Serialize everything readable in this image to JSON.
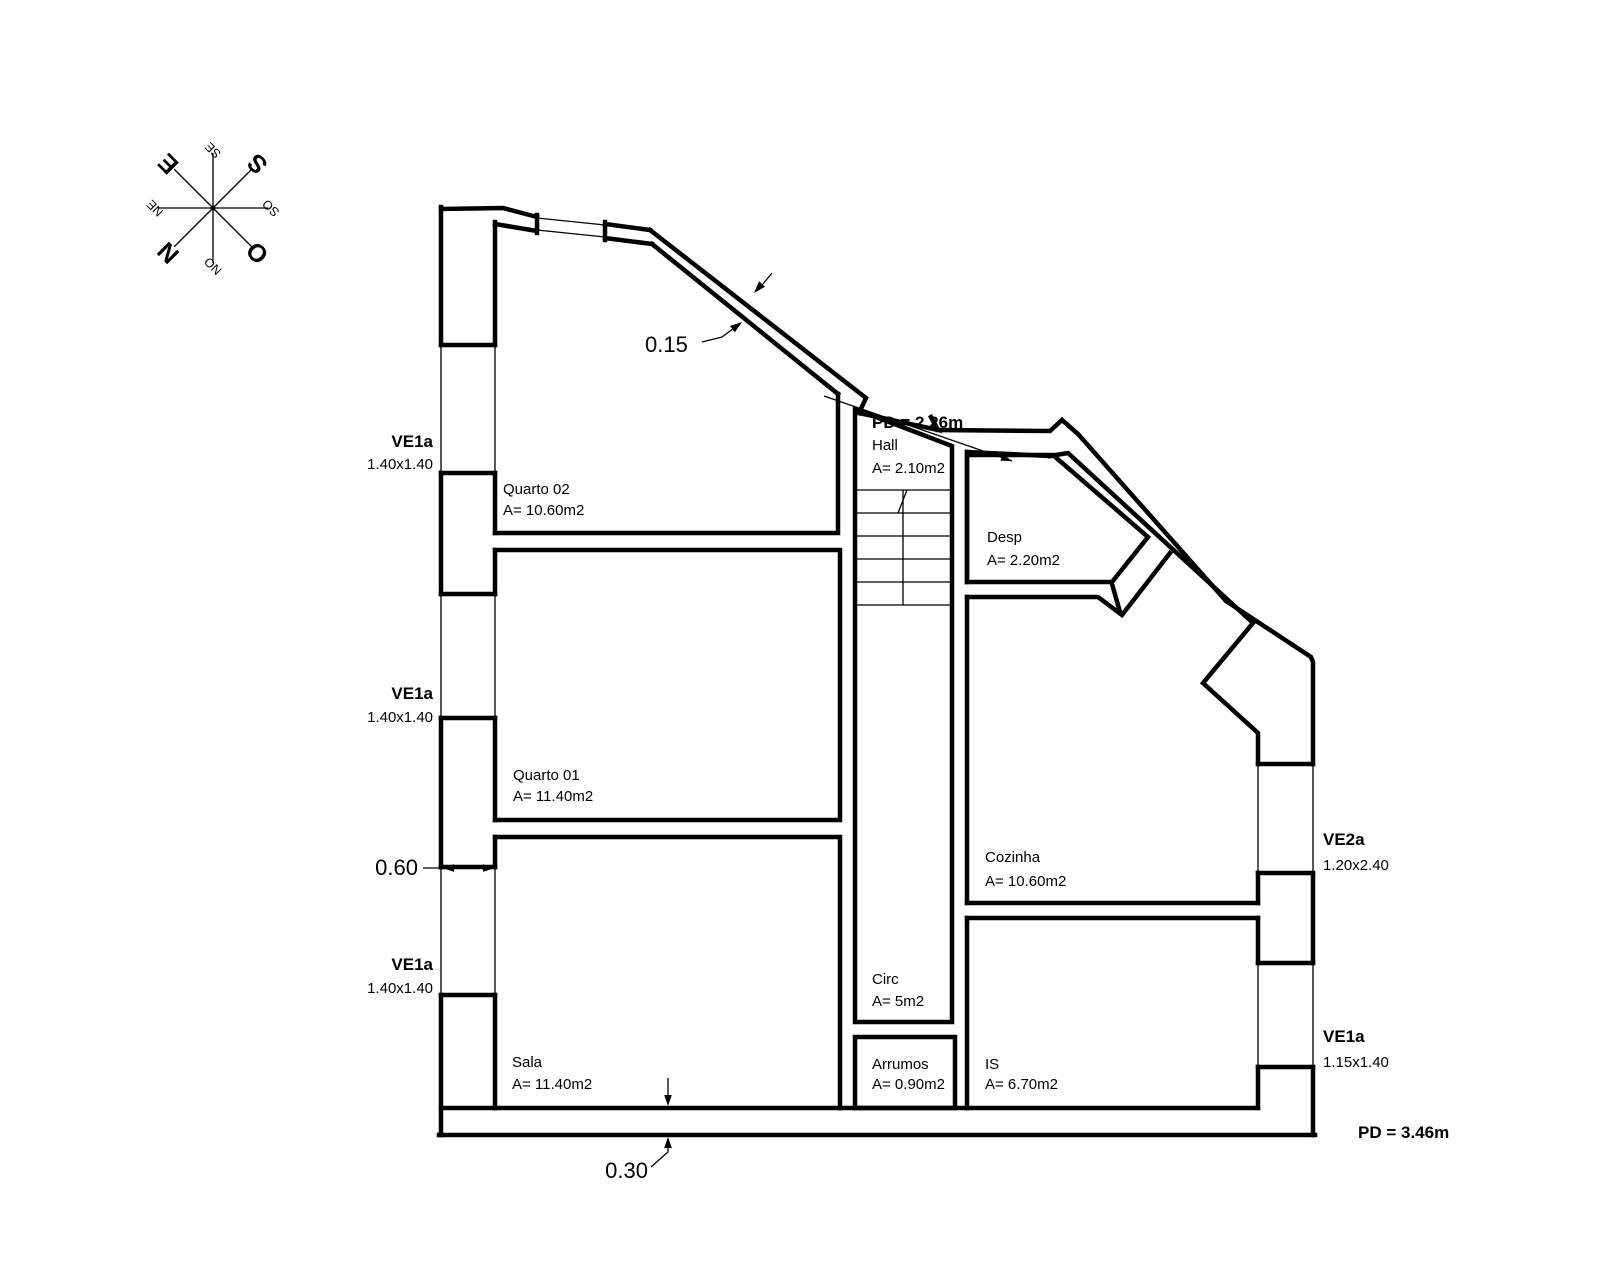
{
  "compass": {
    "n": "N",
    "e": "E",
    "s": "S",
    "o": "O",
    "ne": "NE",
    "se": "SE",
    "so": "SO",
    "no": "NO"
  },
  "rooms": {
    "quarto02": {
      "name": "Quarto 02",
      "area": "A= 10.60m2"
    },
    "quarto01": {
      "name": "Quarto 01",
      "area": "A= 11.40m2"
    },
    "sala": {
      "name": "Sala",
      "area": "A= 11.40m2"
    },
    "hall": {
      "name": "Hall",
      "area": "A= 2.10m2"
    },
    "circ": {
      "name": "Circ",
      "area": "A= 5m2"
    },
    "arrumos": {
      "name": "Arrumos",
      "area": "A= 0.90m2"
    },
    "desp": {
      "name": "Desp",
      "area": "A= 2.20m2"
    },
    "cozinha": {
      "name": "Cozinha",
      "area": "A= 10.60m2"
    },
    "is": {
      "name": "IS",
      "area": "A= 6.70m2"
    }
  },
  "windows": {
    "left_top": {
      "code": "VE1a",
      "size": "1.40x1.40"
    },
    "left_middle": {
      "code": "VE1a",
      "size": "1.40x1.40"
    },
    "left_bottom": {
      "code": "VE1a",
      "size": "1.40x1.40"
    },
    "right_top": {
      "code": "VE2a",
      "size": "1.20x2.40"
    },
    "right_bottom": {
      "code": "VE1a",
      "size": "1.15x1.40"
    }
  },
  "ceiling_heights": {
    "hall": "PD = 2.26m",
    "main": "PD = 3.46m"
  },
  "dimensions": {
    "diagonal_wall": "0.15",
    "left_wall": "0.60",
    "bottom_wall": "0.30"
  },
  "colors": {
    "line": "#000000",
    "dimension": "#b5323f",
    "background": "#ffffff"
  }
}
